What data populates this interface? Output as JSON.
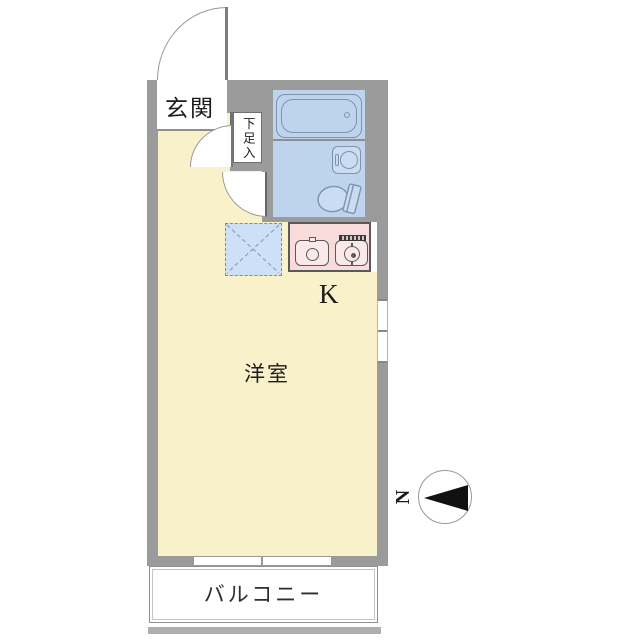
{
  "floorplan": {
    "labels": {
      "entrance": "玄関",
      "shoe_storage": "下足入",
      "kitchen": "K",
      "western_room": "洋室",
      "balcony": "バルコニー",
      "compass_north": "N"
    },
    "colors": {
      "wall": "#9b9b9b",
      "room_floor": "#f8f1ca",
      "bathroom_floor": "#bdd3ee",
      "fixture_fill": "#c9dcf2",
      "kitchen_counter": "#f8dbdb",
      "appliance_space_fill": "#cde0f6",
      "balcony_fill": "#ffffff",
      "dark_outline": "#5a5a5a",
      "fixture_outline": "#8093ab",
      "compass_arrow": "#111111",
      "text": "#1c1c1c"
    }
  }
}
